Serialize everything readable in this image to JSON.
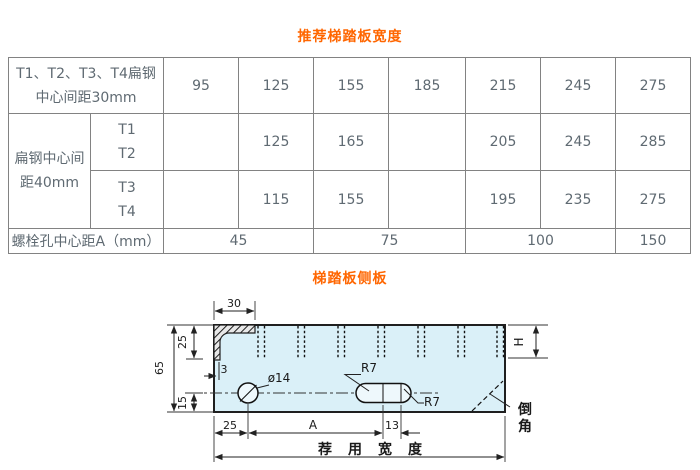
{
  "page": {
    "title1": "推荐梯踏板宽度",
    "title2": "梯踏板侧板"
  },
  "table": {
    "row1": {
      "header_line1": "T1、T2、T3、T4扁钢",
      "header_line2": "中心间距30mm",
      "values": [
        "95",
        "125",
        "155",
        "185",
        "215",
        "245",
        "275"
      ]
    },
    "row23": {
      "header_line1": "扁钢中心间",
      "header_line2": "距40mm"
    },
    "row2": {
      "sub": [
        "T1",
        "T2"
      ],
      "values": [
        "",
        "125",
        "165",
        "",
        "205",
        "245",
        "285"
      ]
    },
    "row3": {
      "sub": [
        "T3",
        "T4"
      ],
      "values": [
        "",
        "115",
        "155",
        "",
        "195",
        "235",
        "275"
      ]
    },
    "row4": {
      "header": "螺栓孔中心距A（mm）",
      "values": [
        "45",
        "75",
        "100",
        "150"
      ]
    }
  },
  "diagram": {
    "dims": {
      "top_width": "30",
      "left_total": "65",
      "left_upper": "25",
      "left_lower": "15",
      "thickness": "3",
      "hole_dia": "ø14",
      "slot_r_top": "R7",
      "slot_r_bottom": "R7",
      "right_depth": "H",
      "hole_offset": "25",
      "hole_spacing": "A",
      "slot_pitch": "13",
      "overall_width": "荐用宽度",
      "chamfer_char1": "倒",
      "chamfer_char2": "角"
    }
  },
  "colors": {
    "accent_orange": "#ff6600",
    "table_border": "#828282",
    "table_text": "#5f6a72",
    "plate_fill": "#daf0f8",
    "line": "#1f1f1f"
  }
}
